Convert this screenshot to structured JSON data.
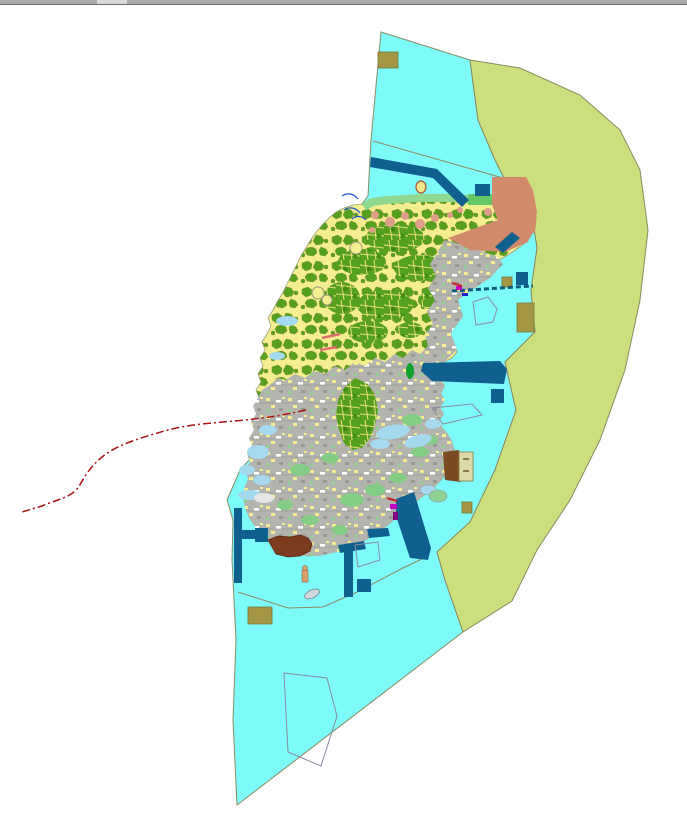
{
  "window": {
    "top_scrollbar": {
      "track_color": "#a8a8a8",
      "thumb_color": "#d8d8d8"
    }
  },
  "map": {
    "background_color": "#ffffff",
    "colors": {
      "water": "#7dfbfb",
      "east_zone": "#cbe07d",
      "farmland_yellow": "#f4ee90",
      "vegetation_green": "#55a11e",
      "vegetation_outline": "#7d8f2e",
      "coastal_green": "#8fd88f",
      "medium_green": "#84cd84",
      "bright_green": "#0da32c",
      "urban_gray": "#b4b4ae",
      "salmon_zone": "#d18a6c",
      "salmon_dot": "#df9d8a",
      "harbor_blue": "#0f608f",
      "olive_block": "#a39743",
      "brown_area": "#7b3c1f",
      "building_brown": "#7b4a22",
      "building_tan": "#ded9a8",
      "pale_blue_shallow": "#a5d9ef",
      "boundary_gray": "#8a8a62",
      "maritime_red": "#aa1111",
      "coast_red": "#e07070",
      "magenta_mark": "#c000c0",
      "purple_mark": "#800080",
      "stream_blue": "#2255cc",
      "causeway_teal": "#0c5a7d",
      "marker_yellow": "#f0e68c",
      "marker_outline": "#b05030",
      "white_flat": "#e6e6e6"
    },
    "legend_semantics": {
      "water_zone": "coastal water planning zone",
      "east_zone": "eastern sea-use planning zone",
      "island": "main island land-use mosaic",
      "maritime_line": "dash-dot maritime boundary line"
    }
  }
}
